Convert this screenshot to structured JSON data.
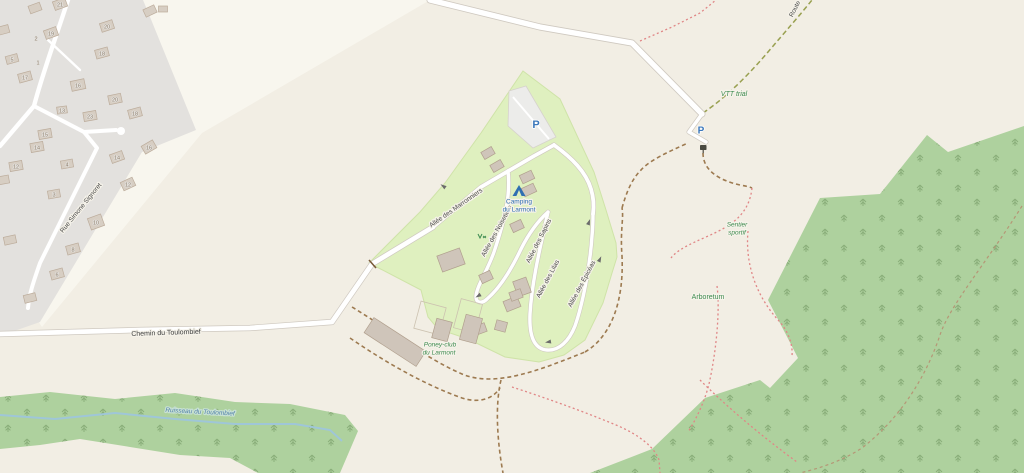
{
  "map": {
    "title": "Camping du Larmont map",
    "palette": {
      "land": "#f2eee4",
      "land_light": "#f8f6ee",
      "residential": "#e3e1de",
      "campground": "#dff0bf",
      "forest": "#aed19e",
      "water": "#9fc6d8",
      "road": "#ffffff",
      "building": "#cfc5ba",
      "parking_blue": "#3c78bb",
      "tourism_blue": "#2f6fb2",
      "leisure_green": "#3d8b50",
      "track_brown": "#9d7a50",
      "footpath_red": "#e08686"
    },
    "labels": {
      "street_rue": "Rue Simone Signoret",
      "street_chemin": "Chemin du Toulombief",
      "street_route_partial": "Route",
      "allee_marronniers": "Allée des Marronniers",
      "allee_noisetiers": "Allée des Noisetiers",
      "allee_sapins": "Allée des Sapins",
      "allee_lilas": "Allée des Lilas",
      "allee_epiceas": "Allée des Épicéas",
      "camping_line1": "Camping",
      "camping_line2": "du Larmont",
      "poney_line1": "Poney-club",
      "poney_line2": "du Larmont",
      "vtt": "VTT trial",
      "sentier_line1": "Sentier",
      "sentier_line2": "sportif",
      "arboretum": "Arboretum",
      "stream": "Ruisseau du Toulombief",
      "parking": "P"
    },
    "icons": [
      "parking-icon",
      "campsite-tent-icon",
      "information-board-icon",
      "playground-icon",
      "gate-icon",
      "oneway-arrow-icon"
    ],
    "residential": {
      "house_numbers": [
        "21",
        "20",
        "19",
        "18",
        "17",
        "16",
        "5",
        "13",
        "23",
        "20",
        "18",
        "15",
        "14",
        "16",
        "14",
        "12",
        "4",
        "12",
        "10",
        "3",
        "8",
        "6",
        "2",
        "1"
      ]
    }
  }
}
